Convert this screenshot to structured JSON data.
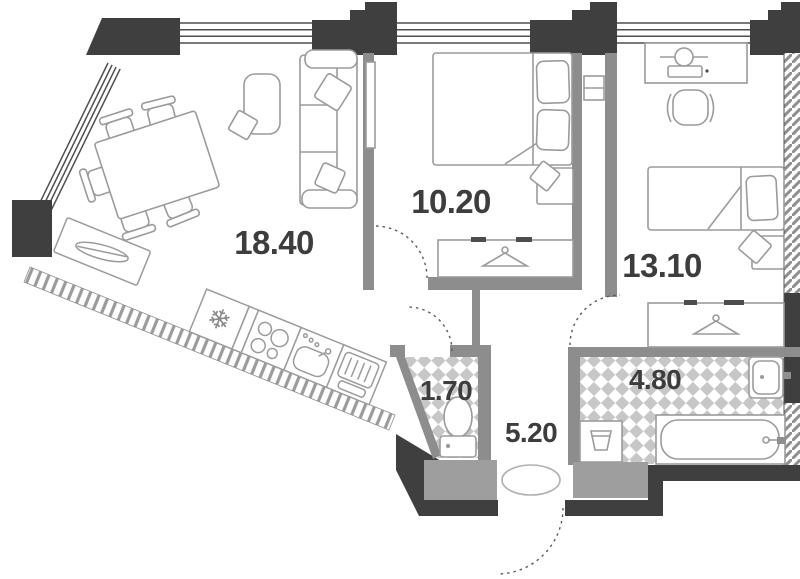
{
  "plan": {
    "type": "apartment-floor-plan",
    "rooms": [
      {
        "key": "living-kitchen",
        "area": "18.40"
      },
      {
        "key": "bedroom",
        "area": "10.20"
      },
      {
        "key": "bedroom-2",
        "area": "13.10"
      },
      {
        "key": "wc",
        "area": "1.70"
      },
      {
        "key": "hallway",
        "area": "5.20"
      },
      {
        "key": "bathroom",
        "area": "4.80"
      }
    ],
    "icons": {
      "fridge": "❄"
    },
    "colors": {
      "wall_dark": "#3f3f3f",
      "wall_gray": "#8d8d8d",
      "wall_medium": "#9e9e9e",
      "tile": "#c7c7c7",
      "furniture_stroke": "#9b9b9b",
      "label": "#3d3d3d",
      "background": "#ffffff"
    }
  }
}
